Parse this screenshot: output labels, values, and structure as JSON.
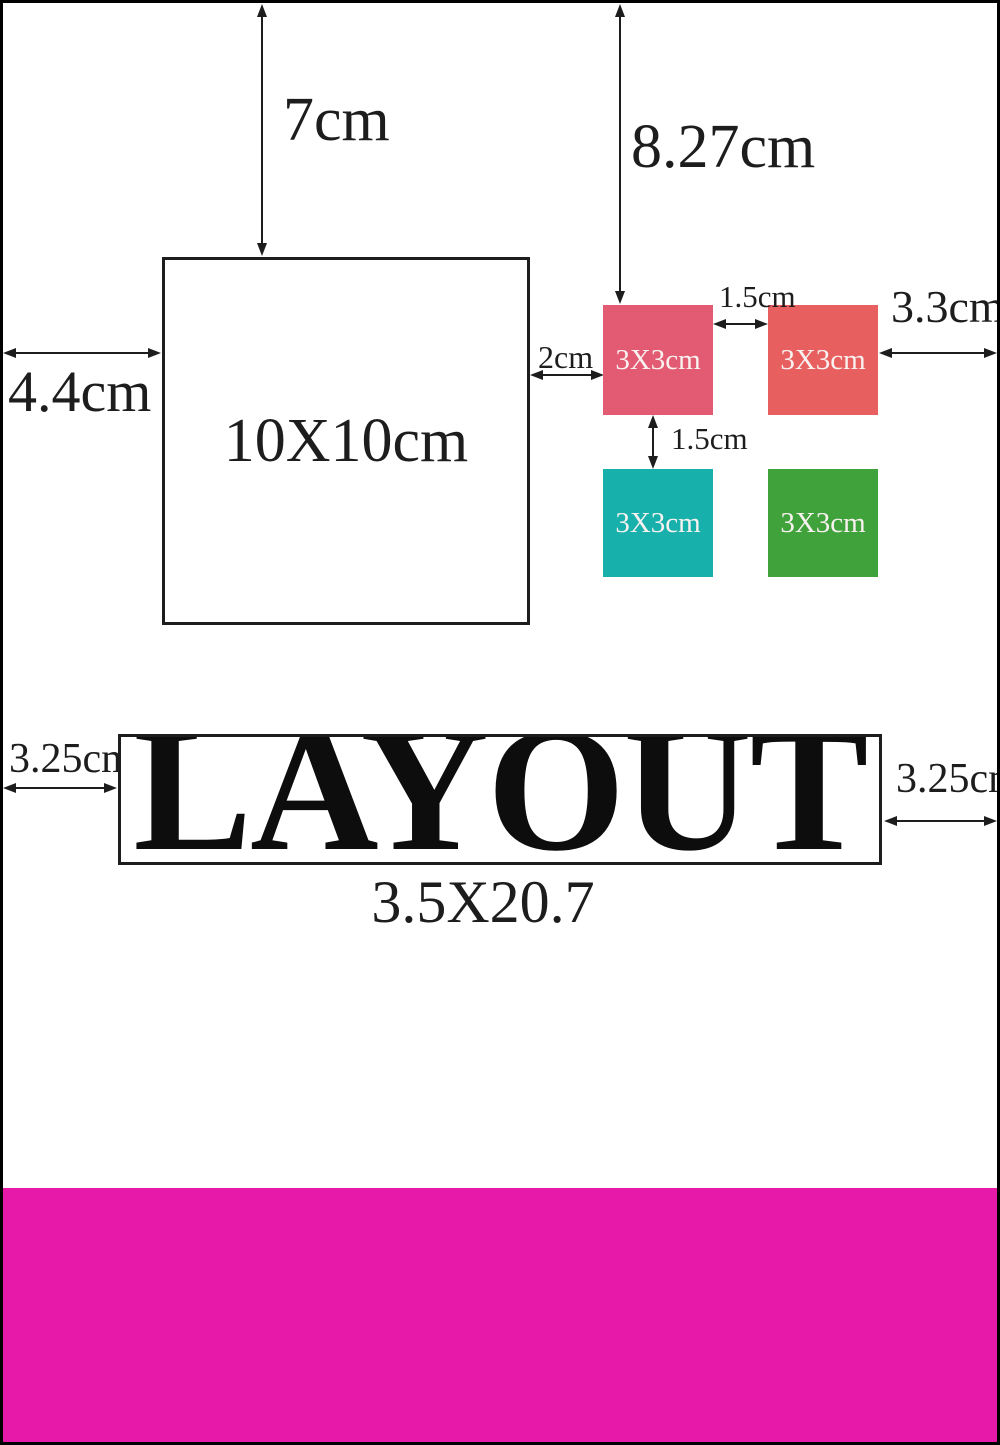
{
  "main_square": {
    "label": "10X10cm"
  },
  "small_squares": [
    {
      "label": "3X3cm",
      "color": "#e25b72"
    },
    {
      "label": "3X3cm",
      "color": "#e85f5f"
    },
    {
      "label": "3X3cm",
      "color": "#17b0ab"
    },
    {
      "label": "3X3cm",
      "color": "#3fa23a"
    }
  ],
  "dimensions": {
    "top_to_main_square": "7cm",
    "top_to_small_squares": "8.27cm",
    "left_to_main_square": "4.4cm",
    "main_square_to_small": "2cm",
    "between_small_horizontal": "1.5cm",
    "between_small_vertical": "1.5cm",
    "small_to_right_edge": "3.3cm",
    "left_to_title_box": "3.25cm",
    "title_box_to_right_edge": "3.25cm"
  },
  "title": {
    "text": "LAYOUT",
    "size_label": "3.5X20.7"
  },
  "bottom_bar": {
    "color": "#e619a8"
  },
  "ink_color": "#1d1d1d"
}
